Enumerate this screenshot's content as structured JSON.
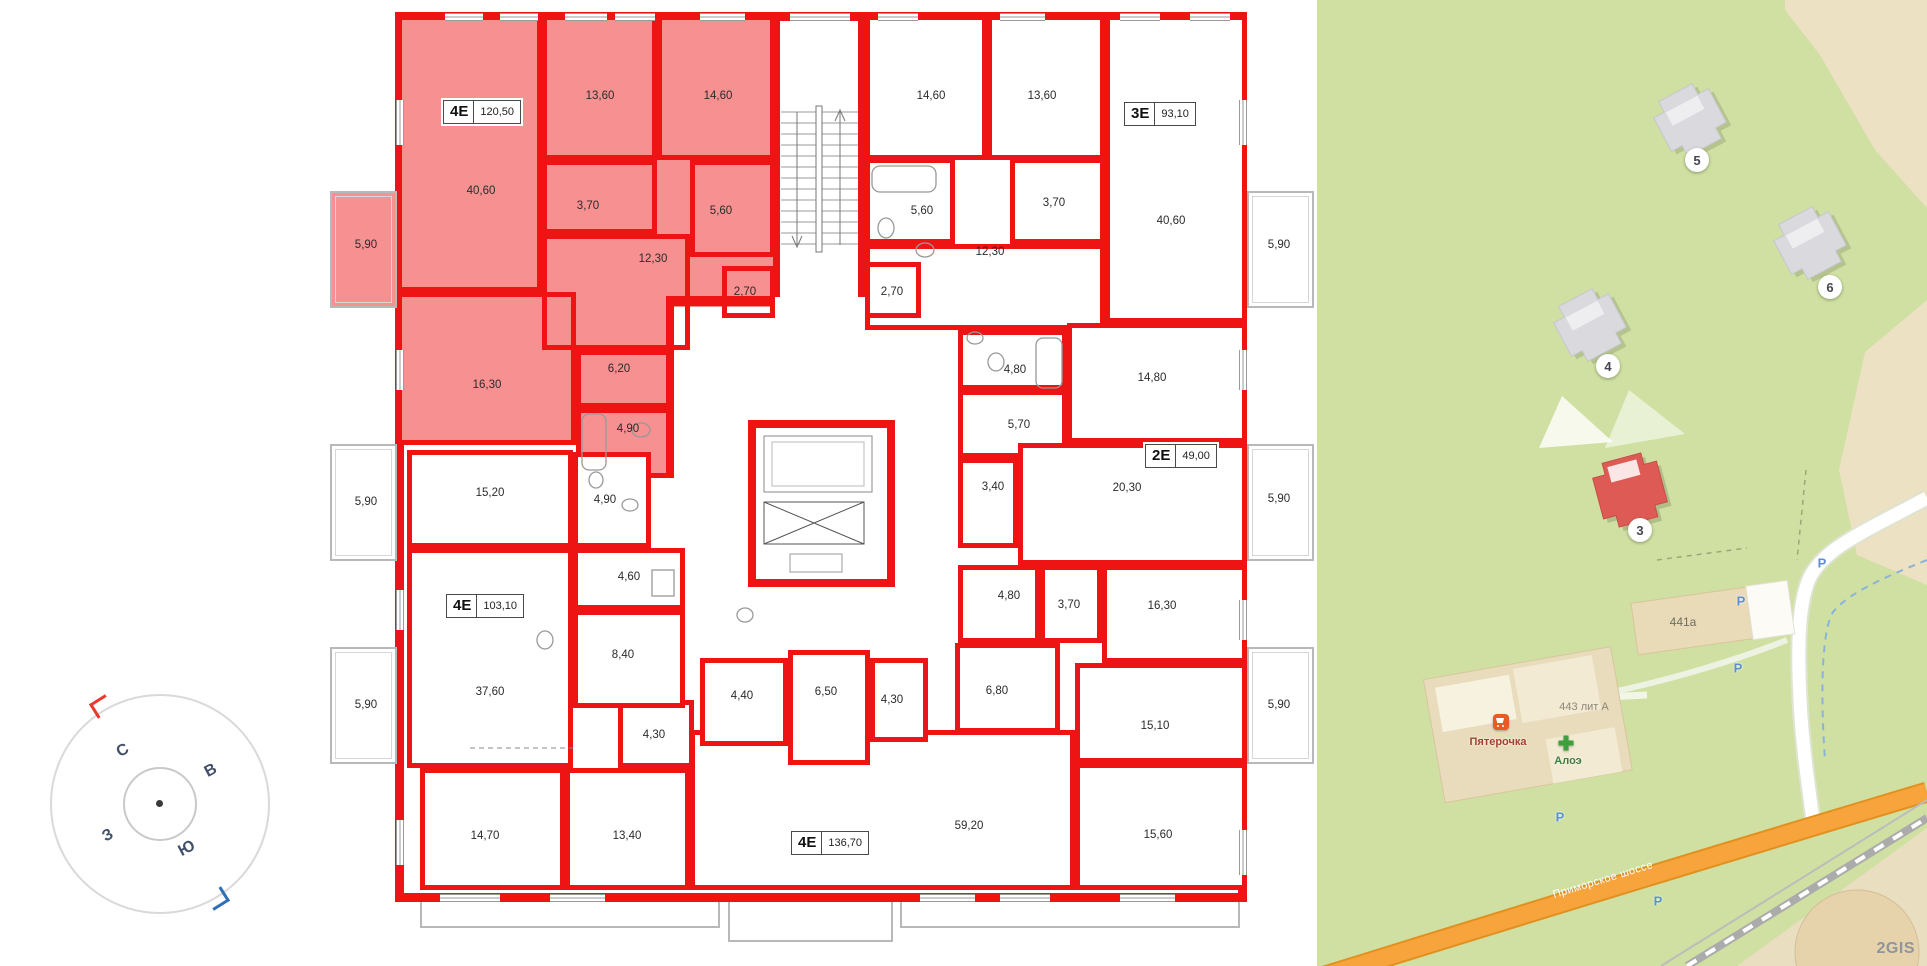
{
  "colors": {
    "wall_red": "#ee1414",
    "highlight_pink": "#f79090",
    "map_green": "#cfe0a2",
    "map_beige": "#ece1c3",
    "building_grey": "#d9d9de",
    "building_red": "#de5b55",
    "road_orange": "#f7a43c"
  },
  "floorplan": {
    "apartments": [
      {
        "type": "4Е",
        "area": "120,50",
        "highlighted": true
      },
      {
        "type": "3Е",
        "area": "93,10",
        "highlighted": false
      },
      {
        "type": "2Е",
        "area": "49,00",
        "highlighted": false
      },
      {
        "type": "4Е",
        "area": "103,10",
        "highlighted": false
      },
      {
        "type": "4Е",
        "area": "136,70",
        "highlighted": false
      }
    ],
    "rooms": [
      "40,60",
      "13,60",
      "14,60",
      "3,70",
      "5,60",
      "12,30",
      "2,70",
      "6,20",
      "16,30",
      "4,90",
      "5,90",
      "14,60",
      "13,60",
      "5,60",
      "3,70",
      "12,30",
      "2,70",
      "40,60",
      "5,90",
      "4,80",
      "14,80",
      "5,70",
      "3,40",
      "20,30",
      "5,90",
      "4,80",
      "3,70",
      "16,30",
      "6,80",
      "15,10",
      "15,60",
      "59,20",
      "5,90",
      "4,40",
      "6,50",
      "4,30",
      "4,30",
      "14,70",
      "13,40",
      "15,20",
      "4,90",
      "4,60",
      "8,40",
      "37,60",
      "5,90",
      "5,90"
    ],
    "compass": [
      "С",
      "В",
      "Ю",
      "З"
    ]
  },
  "map": {
    "badges": [
      "5",
      "6",
      "4",
      "3"
    ],
    "labels": {
      "b441": "441а",
      "b443": "443 лит А",
      "shop": "Пятерочка",
      "pharmacy": "Алоэ",
      "road": "Приморское шоссе",
      "watermark": "2GIS",
      "parking": "P"
    }
  }
}
